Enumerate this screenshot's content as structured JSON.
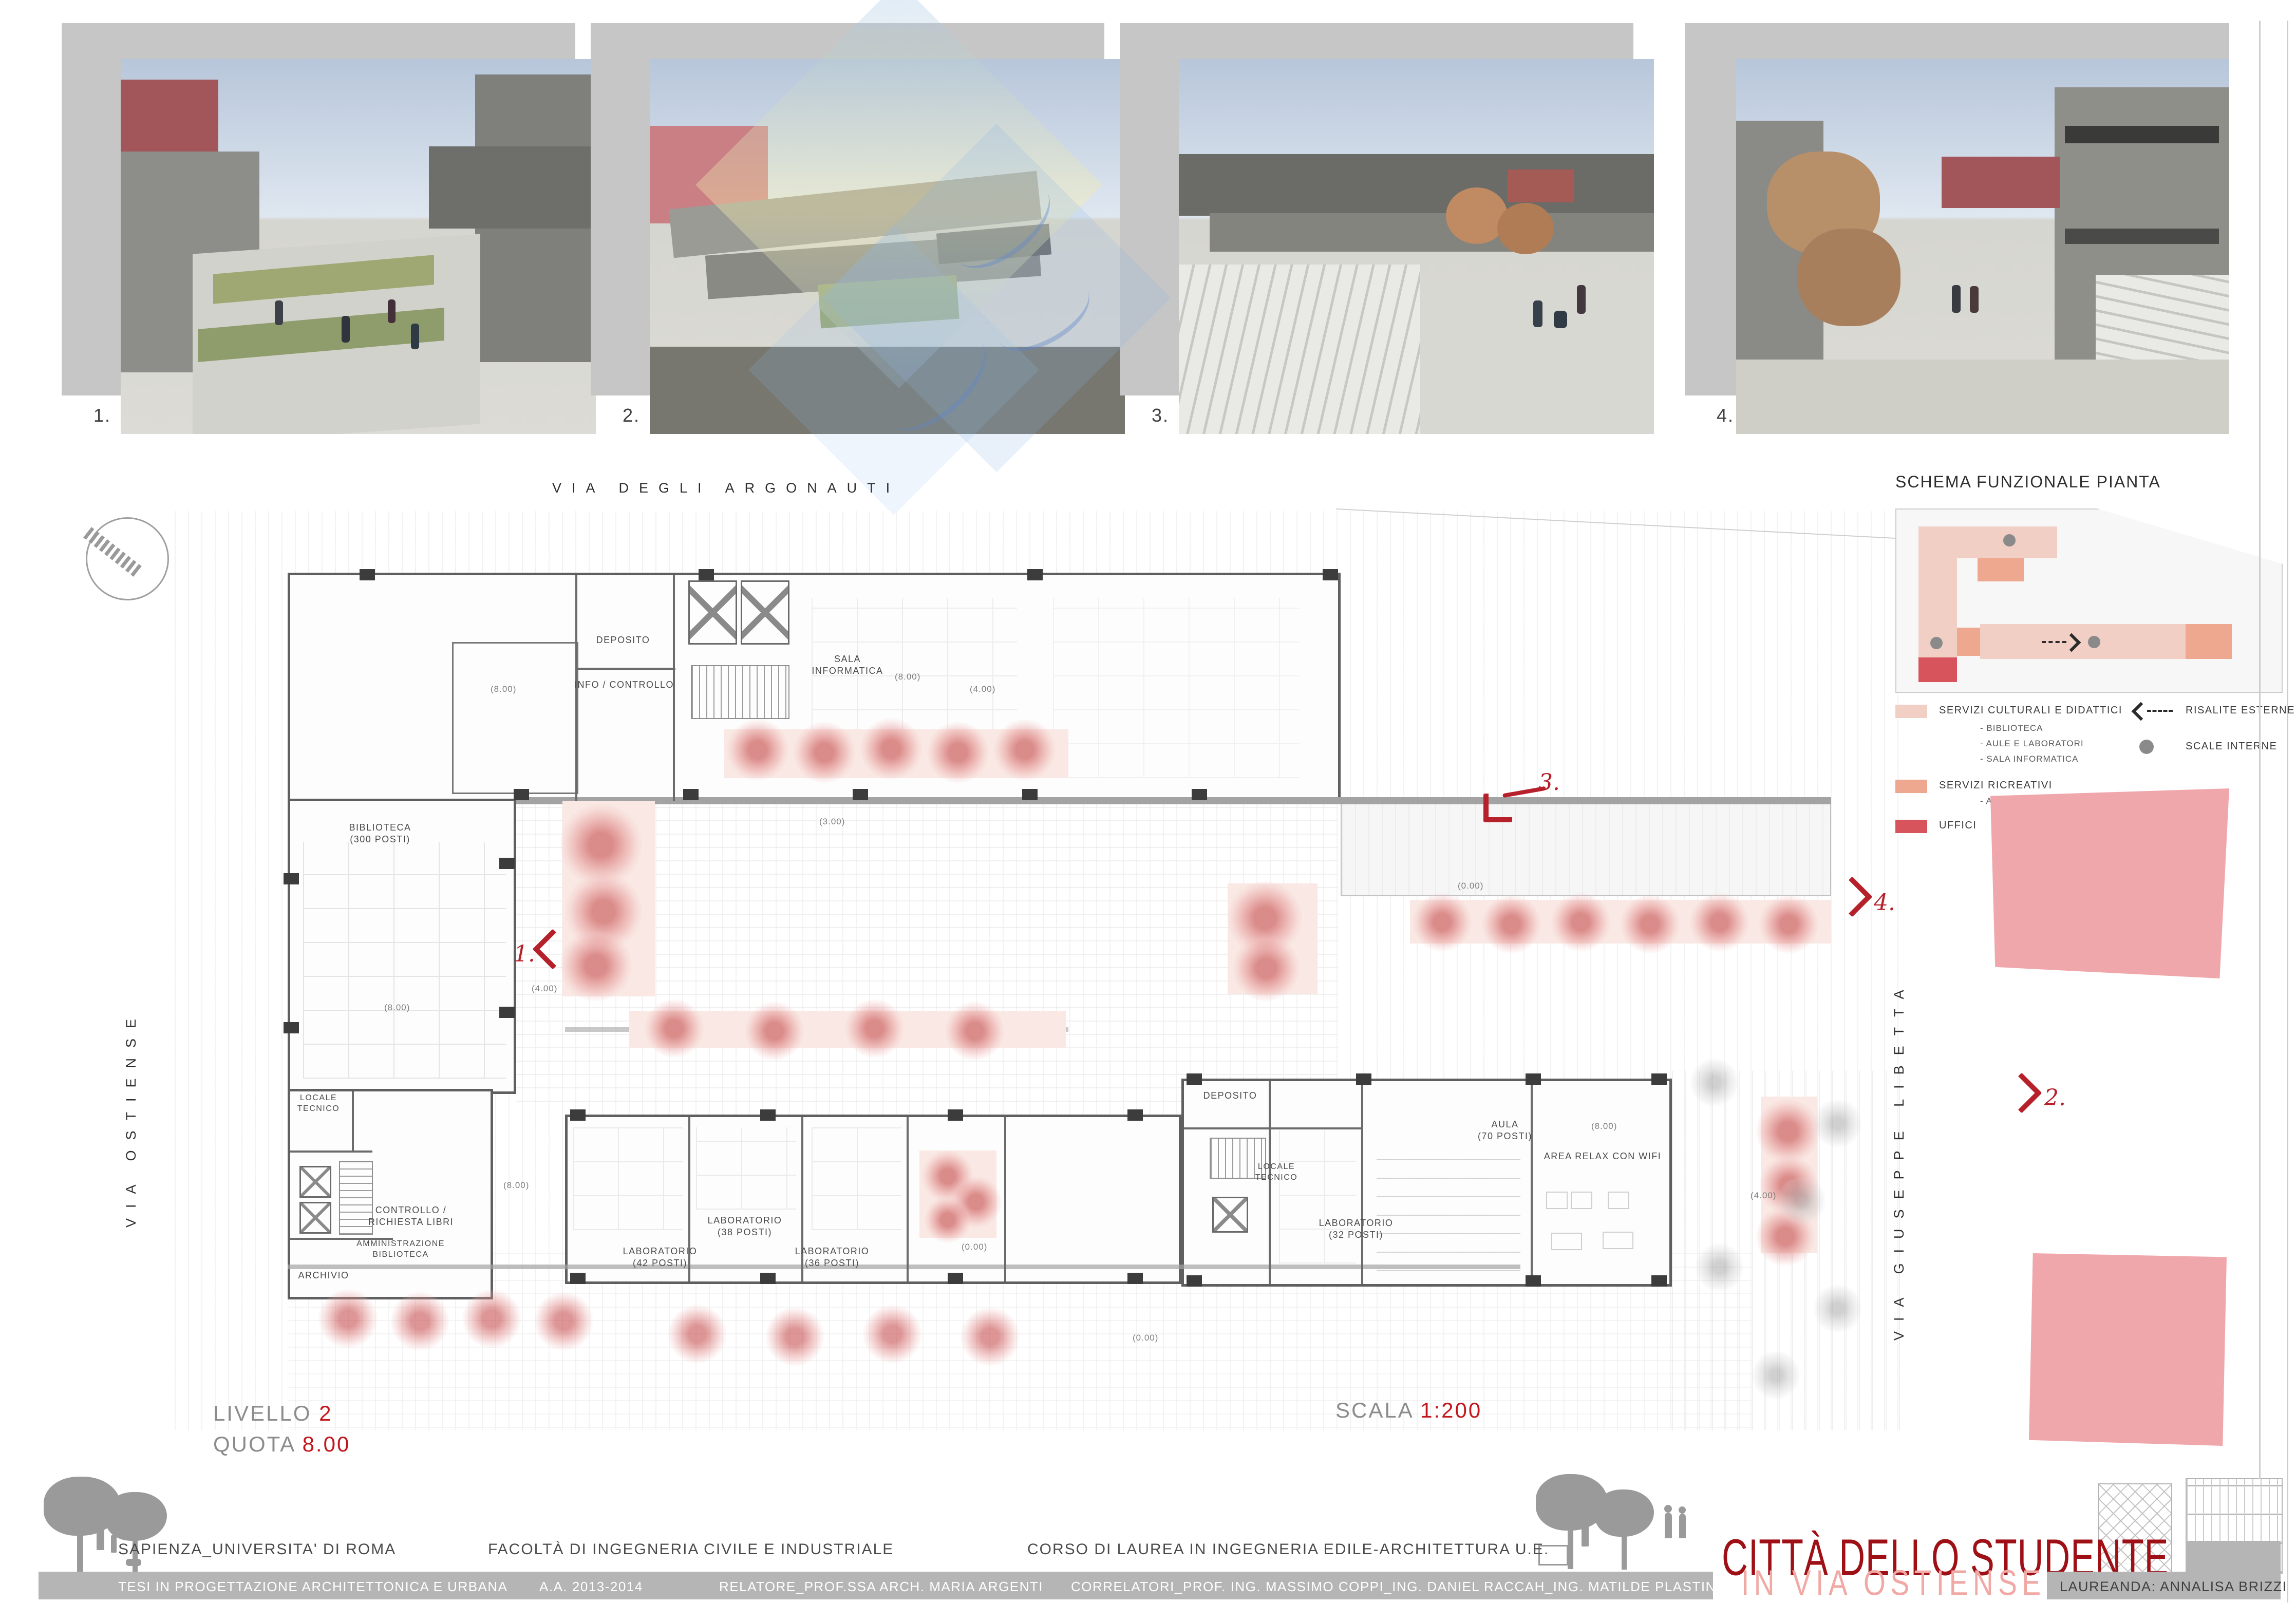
{
  "renders": {
    "numbers": [
      "1.",
      "2.",
      "3.",
      "4."
    ]
  },
  "streets": {
    "top": "VIA DEGLI ARGONAUTI",
    "left": "VIA OSTIENSE",
    "right": "VIA GIUSEPPE LIBETTA"
  },
  "legend": {
    "title": "SCHEMA FUNZIONALE PIANTA",
    "items": [
      {
        "label": "SERVIZI CULTURALI E DIDATTICI",
        "color": "#f2cfc4",
        "sub": [
          "- BIBLIOTECA",
          "- AULE E LABORATORI",
          "- SALA INFORMATICA"
        ]
      },
      {
        "label": "SERVIZI RICREATIVI",
        "color": "#eda88f",
        "sub": [
          "- AREE RELAX"
        ]
      },
      {
        "label": "UFFICI",
        "color": "#d8545c",
        "sub": []
      }
    ],
    "symbols": [
      {
        "label": "RISALITE ESTERNE"
      },
      {
        "label": "SCALE INTERNE"
      }
    ]
  },
  "plan": {
    "rooms": [
      "BIBLIOTECA\n(300 POSTI)",
      "DEPOSITO",
      "INFO / CONTROLLO",
      "SALA\nINFORMATICA",
      "LOCALE\nTECNICO",
      "CONTROLLO /\nRICHIESTA LIBRI",
      "AMMINISTRAZIONE\nBIBLIOTECA",
      "ARCHIVIO",
      "LABORATORIO\n(42 POSTI)",
      "LABORATORIO\n(38 POSTI)",
      "LABORATORIO\n(36 POSTI)",
      "DEPOSITO",
      "LOCALE\nTECNICO",
      "LABORATORIO\n(32 POSTI)",
      "AULA\n(70 POSTI)",
      "AREA RELAX CON WIFI"
    ],
    "dims": [
      "(8.00)",
      "(8.00)",
      "(8.00)",
      "(8.00)",
      "(8.00)",
      "(4.00)",
      "(4.00)",
      "(4.00)",
      "(3.00)",
      "(0.00)",
      "(0.00)",
      "(0.00)"
    ],
    "markers": [
      "1.",
      "2.",
      "3.",
      "4."
    ]
  },
  "titleblock": {
    "livello_label": "LIVELLO",
    "livello_value": "2",
    "quota_label": "QUOTA",
    "quota_value": "8.00",
    "scala_label": "SCALA",
    "scala_value": "1:200"
  },
  "footer": {
    "university": "SAPIENZA_UNIVERSITA' DI ROMA",
    "faculty": "FACOLTÀ DI INGEGNERIA CIVILE E INDUSTRIALE",
    "course": "CORSO DI LAUREA IN INGEGNERIA EDILE-ARCHITETTURA U.E.",
    "thesis": "TESI IN PROGETTAZIONE ARCHITETTONICA E URBANA",
    "year": "A.A. 2013-2014",
    "relatore": "RELATORE_PROF.SSA ARCH. MARIA ARGENTI",
    "correlatori": "CORRELATORI_PROF. ING. MASSIMO COPPI_ING. DANIEL RACCAH_ING. MATILDE PLASTINA",
    "project_title": "CITTÀ DELLO STUDENTE",
    "project_subtitle": "IN VIA OSTIENSE",
    "laureanda": "LAUREANDA: ANNALISA BRIZZI"
  },
  "colors": {
    "accent_red": "#b6202a",
    "title_red": "#9e1016",
    "title_pink": "#f0a9a4",
    "servizi_culturali": "#f2cfc4",
    "servizi_ricreativi": "#eda88f",
    "uffici": "#d8545c",
    "footer_strip": "#b5b5b5"
  }
}
